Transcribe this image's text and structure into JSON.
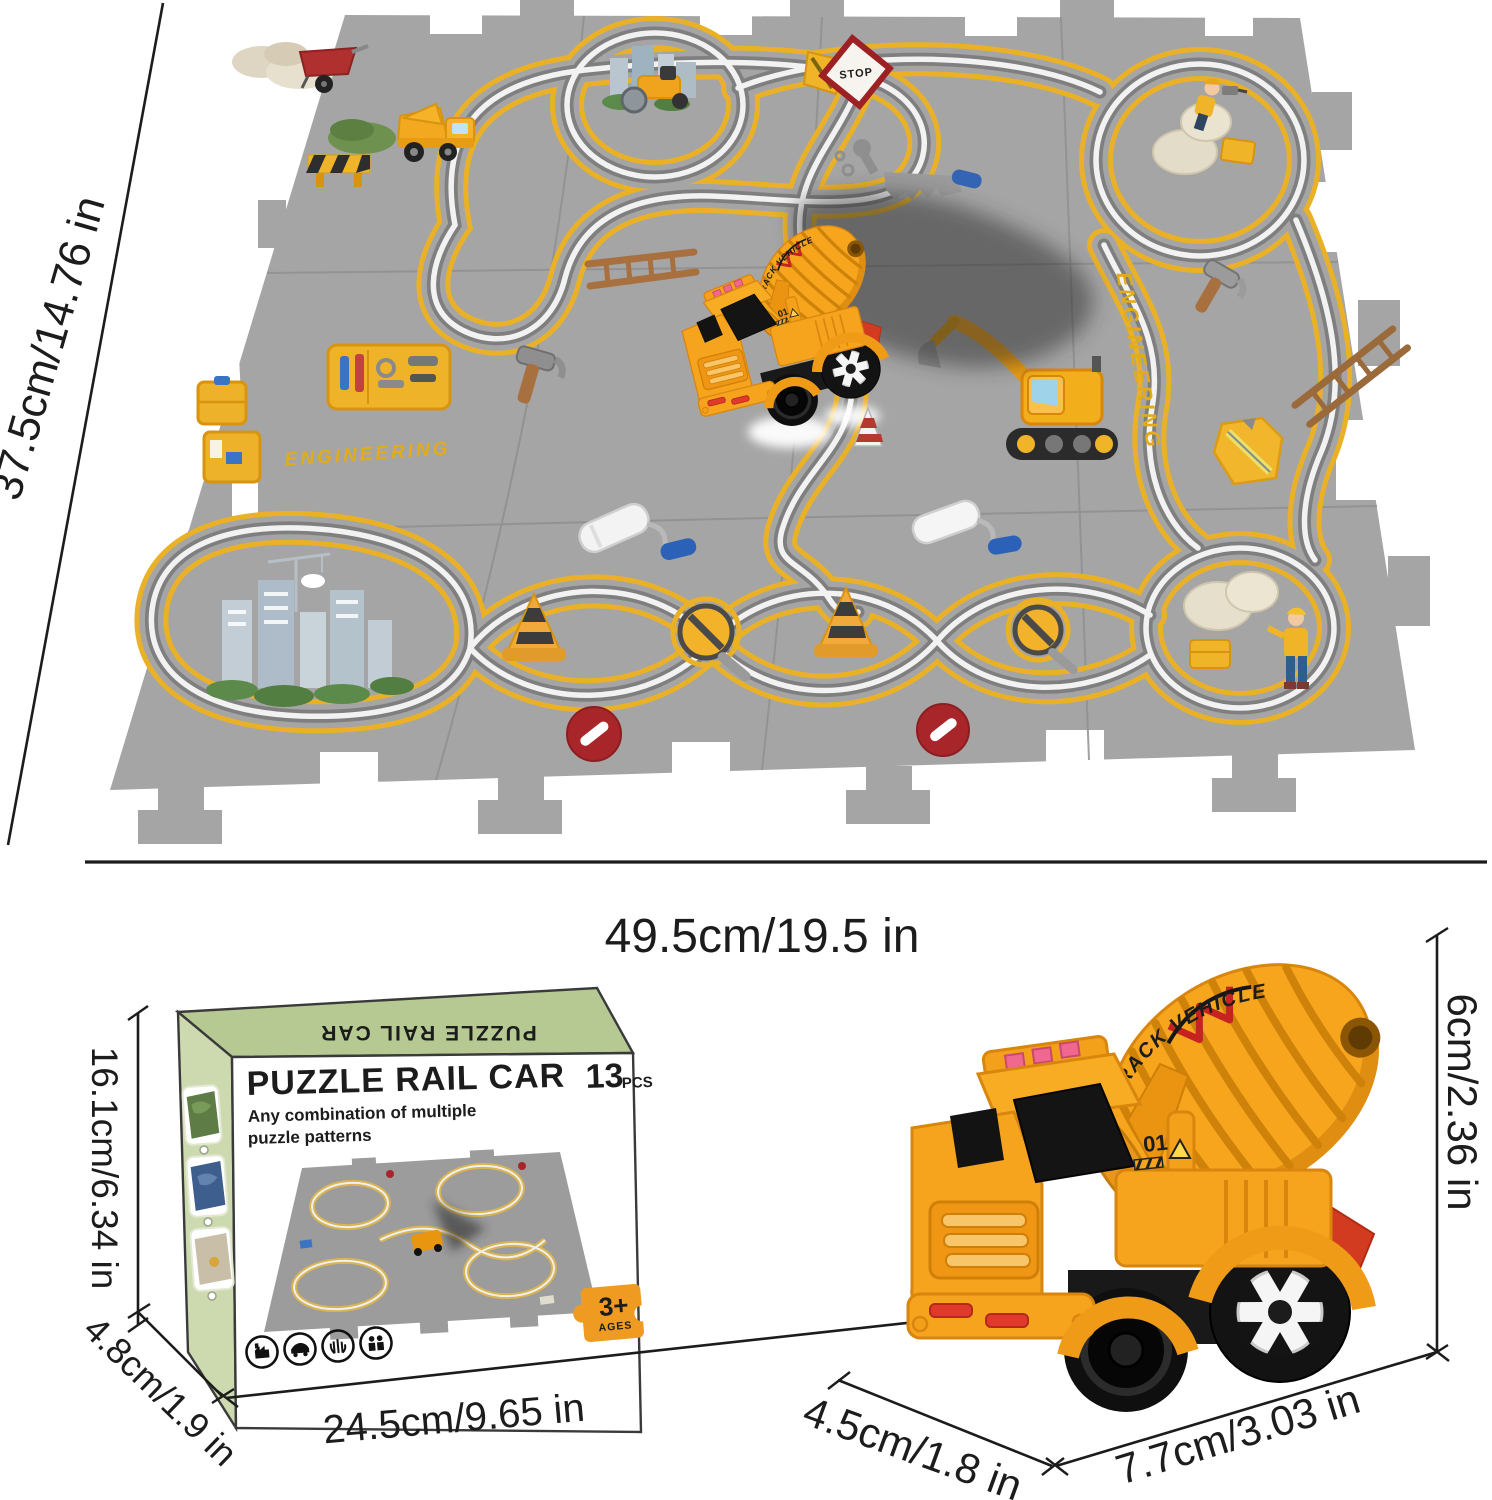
{
  "dims": {
    "mat_height": "37.5cm/14.76 in",
    "mat_width": "49.5cm/19.5 in",
    "box_height": "16.1cm/6.34 in",
    "box_depth": "4.8cm/1.9 in",
    "box_width": "24.5cm/9.65 in",
    "truck_height": "6cm/2.36 in",
    "truck_depth": "4.5cm/1.8 in",
    "truck_length": "7.7cm/3.03 in"
  },
  "mat": {
    "engineering_center": "ENGINEERING",
    "engineering_right": "ENGINEERING",
    "stop_sign": "STOP"
  },
  "box": {
    "flap_text": "PUZZLE RAIL CAR",
    "title": "PUZZLE RAIL CAR",
    "subtitle_line1": "Any combination of multiple",
    "subtitle_line2": "puzzle patterns",
    "pieces_number": "13",
    "pieces_unit": "PCS",
    "age_number": "3+",
    "age_label": "AGES"
  },
  "truck": {
    "drum_text": "TRACK VEHICLE",
    "cab_number": "01"
  },
  "icons": [
    "sand-pile-icon",
    "wheelbarrow-icon",
    "dump-truck-icon",
    "barrier-icon",
    "stop-sign-icon",
    "wrench-icon",
    "saw-icon",
    "road-roller-icon",
    "city-icon",
    "worker-drill-icon",
    "ladder-icon",
    "hammer-icon",
    "toolbox-icon",
    "tool-case-icon",
    "safety-vest-icon",
    "paint-roller-icon",
    "traffic-cone-icon",
    "no-sign-icon",
    "no-entry-icon",
    "worker-rocks-icon",
    "excavator-icon",
    "factory-icon",
    "car-icon",
    "hand-icon",
    "people-icon",
    "puzzle-piece-icon"
  ],
  "colors": {
    "mat_gray": "#a5a5a5",
    "track_yellow": "#eab127",
    "rail_light": "#f2f2f2",
    "box_green_top": "#b7c993",
    "box_green_side": "#cdd9ae",
    "title_green": "#9cba74",
    "truck_orange": "#f6a31e",
    "stop_red": "#9c2024",
    "no_entry_red": "#a8262a",
    "age_orange": "#ef9b22"
  }
}
